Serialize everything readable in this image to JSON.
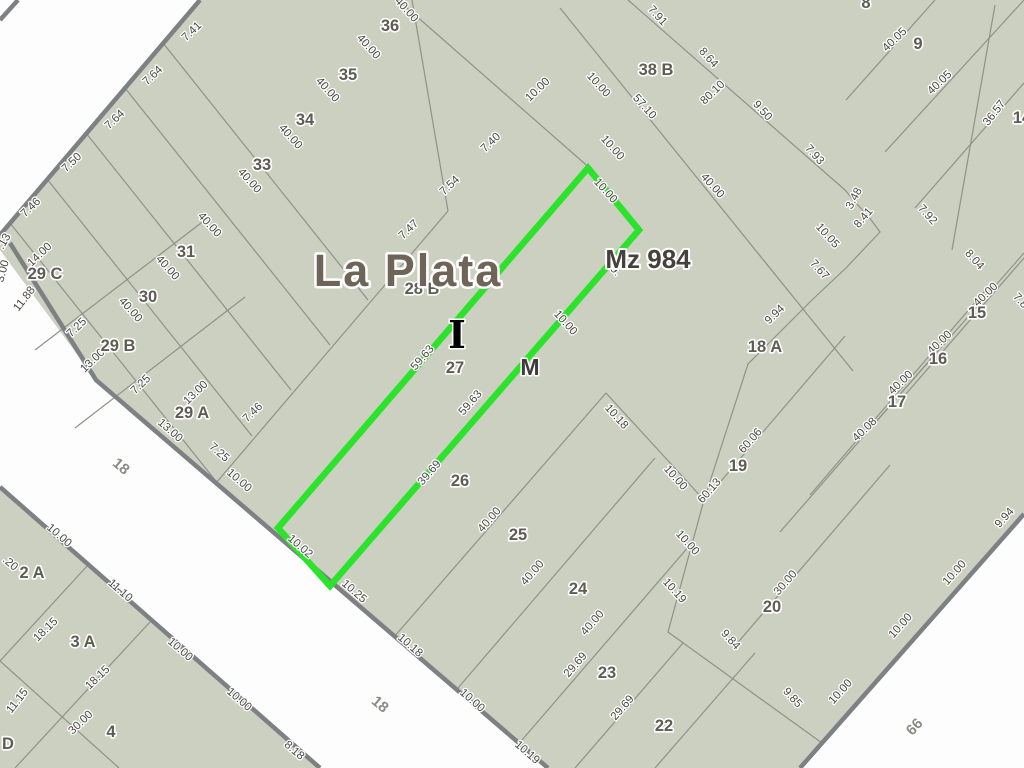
{
  "map": {
    "city_label": "La Plata",
    "block_label": "Mz 984",
    "letter_i": "I",
    "letter_m": "M",
    "highlighted_parcel_number": "27",
    "colors": {
      "parcel_fill": "#cbd0c0",
      "street_fill": "#fdfdfd",
      "curb_gray": "#7e8184",
      "line_gray": "#8f928a",
      "highlight_green": "#2ce32c",
      "dim_text": "#4a4740",
      "parcel_text": "#5f5c54",
      "city_text": "#6e6558"
    },
    "street_labels": [
      {
        "text": "18",
        "x": 118,
        "y": 470,
        "rot": 40
      },
      {
        "text": "18",
        "x": 377,
        "y": 708,
        "rot": 40
      },
      {
        "text": "66",
        "x": 918,
        "y": 730,
        "rot": -48
      }
    ],
    "parcel_labels": [
      {
        "text": "36",
        "x": 390,
        "y": 31
      },
      {
        "text": "35",
        "x": 348,
        "y": 80
      },
      {
        "text": "34",
        "x": 305,
        "y": 125
      },
      {
        "text": "33",
        "x": 262,
        "y": 170
      },
      {
        "text": "31",
        "x": 186,
        "y": 257
      },
      {
        "text": "30",
        "x": 148,
        "y": 302
      },
      {
        "text": "29 C",
        "x": 45,
        "y": 279
      },
      {
        "text": "29 B",
        "x": 118,
        "y": 351
      },
      {
        "text": "29 A",
        "x": 192,
        "y": 418
      },
      {
        "text": "28 B",
        "x": 422,
        "y": 294
      },
      {
        "text": "27",
        "x": 455,
        "y": 373
      },
      {
        "text": "26",
        "x": 460,
        "y": 486
      },
      {
        "text": "25",
        "x": 518,
        "y": 540
      },
      {
        "text": "24",
        "x": 578,
        "y": 594
      },
      {
        "text": "23",
        "x": 607,
        "y": 678
      },
      {
        "text": "22",
        "x": 664,
        "y": 731
      },
      {
        "text": "38 B",
        "x": 656,
        "y": 75
      },
      {
        "text": "8",
        "x": 866,
        "y": 8
      },
      {
        "text": "9",
        "x": 918,
        "y": 49
      },
      {
        "text": "14",
        "x": 1022,
        "y": 123
      },
      {
        "text": "15",
        "x": 977,
        "y": 318
      },
      {
        "text": "16",
        "x": 938,
        "y": 364
      },
      {
        "text": "17",
        "x": 897,
        "y": 407
      },
      {
        "text": "18 A",
        "x": 765,
        "y": 352
      },
      {
        "text": "19",
        "x": 738,
        "y": 471
      },
      {
        "text": "20",
        "x": 772,
        "y": 612
      },
      {
        "text": "2 A",
        "x": 32,
        "y": 578
      },
      {
        "text": "3 A",
        "x": 83,
        "y": 647
      },
      {
        "text": "4",
        "x": 111,
        "y": 737
      },
      {
        "text": "D",
        "x": 8,
        "y": 749
      }
    ],
    "dimension_labels": [
      {
        "text": "7.41",
        "x": 194,
        "y": 34,
        "rot": -44
      },
      {
        "text": "7.64",
        "x": 155,
        "y": 78,
        "rot": -44
      },
      {
        "text": "7.64",
        "x": 117,
        "y": 122,
        "rot": -44
      },
      {
        "text": "7.50",
        "x": 74,
        "y": 165,
        "rot": -44
      },
      {
        "text": "7.46",
        "x": 33,
        "y": 210,
        "rot": -44
      },
      {
        "text": ".13",
        "x": 7,
        "y": 243,
        "rot": -60
      },
      {
        "text": "3.00",
        "x": 6,
        "y": 272,
        "rot": -75
      },
      {
        "text": "14.00",
        "x": 42,
        "y": 257,
        "rot": -44
      },
      {
        "text": "11.88",
        "x": 27,
        "y": 301,
        "rot": -52
      },
      {
        "text": "7.25",
        "x": 79,
        "y": 330,
        "rot": -44
      },
      {
        "text": "13.00",
        "x": 95,
        "y": 363,
        "rot": -44
      },
      {
        "text": "7.25",
        "x": 143,
        "y": 387,
        "rot": -44
      },
      {
        "text": "13.00",
        "x": 198,
        "y": 395,
        "rot": -44
      },
      {
        "text": "7.46",
        "x": 255,
        "y": 415,
        "rot": -44
      },
      {
        "text": "13.00",
        "x": 168,
        "y": 433,
        "rot": 41
      },
      {
        "text": "7.25",
        "x": 217,
        "y": 455,
        "rot": 41
      },
      {
        "text": "10.00",
        "x": 237,
        "y": 483,
        "rot": 41
      },
      {
        "text": "10.02",
        "x": 298,
        "y": 549,
        "rot": 41
      },
      {
        "text": "10.25",
        "x": 352,
        "y": 594,
        "rot": 41
      },
      {
        "text": "10.18",
        "x": 408,
        "y": 648,
        "rot": 41
      },
      {
        "text": "10.00",
        "x": 470,
        "y": 703,
        "rot": 41
      },
      {
        "text": "10.19",
        "x": 525,
        "y": 755,
        "rot": 41
      },
      {
        "text": "10.00",
        "x": 57,
        "y": 538,
        "rot": 41
      },
      {
        "text": ".20",
        "x": 8,
        "y": 566,
        "rot": 41
      },
      {
        "text": "11.10",
        "x": 118,
        "y": 593,
        "rot": 41
      },
      {
        "text": "10.00",
        "x": 178,
        "y": 652,
        "rot": 41
      },
      {
        "text": "10.00",
        "x": 237,
        "y": 702,
        "rot": 41
      },
      {
        "text": "8.18",
        "x": 292,
        "y": 753,
        "rot": 41
      },
      {
        "text": "18.15",
        "x": 48,
        "y": 632,
        "rot": -44
      },
      {
        "text": "18.15",
        "x": 100,
        "y": 680,
        "rot": -44
      },
      {
        "text": "11.15",
        "x": 20,
        "y": 703,
        "rot": -52
      },
      {
        "text": "30.00",
        "x": 83,
        "y": 725,
        "rot": -44
      },
      {
        "text": "40.00",
        "x": 404,
        "y": 12,
        "rot": 48
      },
      {
        "text": "40.00",
        "x": 366,
        "y": 49,
        "rot": 48
      },
      {
        "text": "40.00",
        "x": 325,
        "y": 92,
        "rot": 48
      },
      {
        "text": "40.00",
        "x": 288,
        "y": 139,
        "rot": 48
      },
      {
        "text": "40.00",
        "x": 247,
        "y": 183,
        "rot": 48
      },
      {
        "text": "40.00",
        "x": 207,
        "y": 227,
        "rot": 48
      },
      {
        "text": "40.00",
        "x": 165,
        "y": 270,
        "rot": 48
      },
      {
        "text": "40.00",
        "x": 128,
        "y": 312,
        "rot": 48
      },
      {
        "text": "7.47",
        "x": 411,
        "y": 232,
        "rot": -44
      },
      {
        "text": "7.54",
        "x": 452,
        "y": 188,
        "rot": -44
      },
      {
        "text": "7.40",
        "x": 493,
        "y": 145,
        "rot": -44
      },
      {
        "text": "10.00",
        "x": 540,
        "y": 92,
        "rot": -44
      },
      {
        "text": "10.00",
        "x": 596,
        "y": 87,
        "rot": 48
      },
      {
        "text": "10.00",
        "x": 610,
        "y": 150,
        "rot": 48
      },
      {
        "text": "10.00",
        "x": 603,
        "y": 193,
        "rot": 48
      },
      {
        "text": "9.",
        "x": 613,
        "y": 273,
        "rot": 48
      },
      {
        "text": "10.00",
        "x": 563,
        "y": 325,
        "rot": 48
      },
      {
        "text": "57.10",
        "x": 642,
        "y": 109,
        "rot": 48
      },
      {
        "text": "40.00",
        "x": 710,
        "y": 188,
        "rot": 48
      },
      {
        "text": "7.91",
        "x": 655,
        "y": 18,
        "rot": 48
      },
      {
        "text": "8.64",
        "x": 706,
        "y": 60,
        "rot": 48
      },
      {
        "text": "9.50",
        "x": 760,
        "y": 113,
        "rot": 48
      },
      {
        "text": "7.93",
        "x": 812,
        "y": 157,
        "rot": 48
      },
      {
        "text": "80.10",
        "x": 715,
        "y": 95,
        "rot": -44
      },
      {
        "text": "3.48",
        "x": 857,
        "y": 200,
        "rot": -62
      },
      {
        "text": "8.41",
        "x": 866,
        "y": 220,
        "rot": -50
      },
      {
        "text": "10.05",
        "x": 825,
        "y": 238,
        "rot": 48
      },
      {
        "text": "7.67",
        "x": 817,
        "y": 272,
        "rot": 48
      },
      {
        "text": "9.94",
        "x": 777,
        "y": 317,
        "rot": -44
      },
      {
        "text": "40.05",
        "x": 897,
        "y": 42,
        "rot": -44
      },
      {
        "text": "40.05",
        "x": 942,
        "y": 85,
        "rot": -44
      },
      {
        "text": "36.57",
        "x": 997,
        "y": 115,
        "rot": -52
      },
      {
        "text": "7.92",
        "x": 925,
        "y": 217,
        "rot": 48
      },
      {
        "text": "8.04",
        "x": 972,
        "y": 262,
        "rot": 48
      },
      {
        "text": "7.8",
        "x": 1018,
        "y": 303,
        "rot": 48
      },
      {
        "text": "40.00",
        "x": 988,
        "y": 297,
        "rot": -44
      },
      {
        "text": "40.00",
        "x": 942,
        "y": 345,
        "rot": -44
      },
      {
        "text": "40.00",
        "x": 903,
        "y": 385,
        "rot": -44
      },
      {
        "text": "40.08",
        "x": 867,
        "y": 432,
        "rot": -44
      },
      {
        "text": "59.63",
        "x": 425,
        "y": 360,
        "rot": -49
      },
      {
        "text": "59.63",
        "x": 473,
        "y": 405,
        "rot": -49
      },
      {
        "text": "39.69",
        "x": 432,
        "y": 475,
        "rot": -49
      },
      {
        "text": "40.00",
        "x": 492,
        "y": 522,
        "rot": -49
      },
      {
        "text": "40.00",
        "x": 535,
        "y": 575,
        "rot": -49
      },
      {
        "text": "40.00",
        "x": 595,
        "y": 625,
        "rot": -49
      },
      {
        "text": "29.69",
        "x": 578,
        "y": 667,
        "rot": -49
      },
      {
        "text": "29.69",
        "x": 625,
        "y": 710,
        "rot": -49
      },
      {
        "text": "10.18",
        "x": 614,
        "y": 419,
        "rot": 48
      },
      {
        "text": "10.00",
        "x": 673,
        "y": 480,
        "rot": 48
      },
      {
        "text": "10.00",
        "x": 685,
        "y": 545,
        "rot": 48
      },
      {
        "text": "10.19",
        "x": 672,
        "y": 593,
        "rot": 48
      },
      {
        "text": "60.06",
        "x": 753,
        "y": 443,
        "rot": -49
      },
      {
        "text": "60.13",
        "x": 712,
        "y": 493,
        "rot": -49
      },
      {
        "text": "30.00",
        "x": 788,
        "y": 585,
        "rot": -49
      },
      {
        "text": "9.84",
        "x": 728,
        "y": 642,
        "rot": 48
      },
      {
        "text": "9.85",
        "x": 790,
        "y": 700,
        "rot": 48
      },
      {
        "text": "10.00",
        "x": 843,
        "y": 694,
        "rot": -48
      },
      {
        "text": "10.00",
        "x": 903,
        "y": 628,
        "rot": -48
      },
      {
        "text": "10.00",
        "x": 957,
        "y": 575,
        "rot": -48
      },
      {
        "text": "9.94",
        "x": 1007,
        "y": 520,
        "rot": -48
      }
    ]
  }
}
